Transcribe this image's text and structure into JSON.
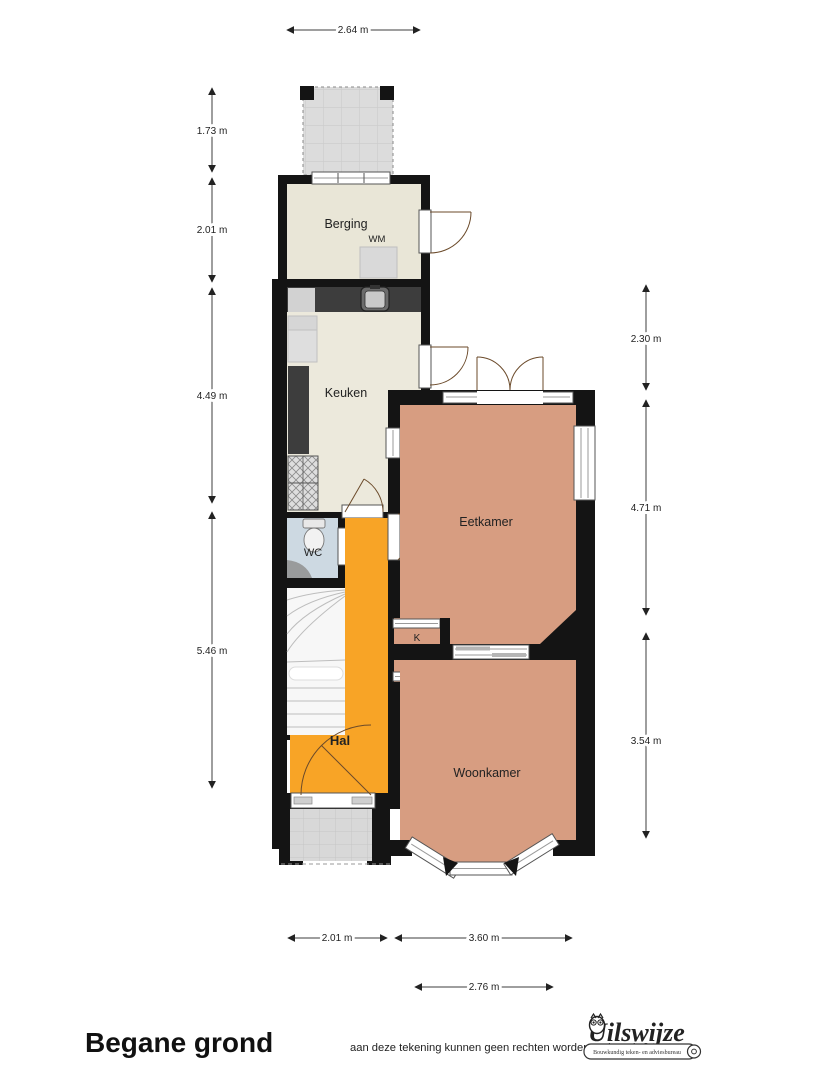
{
  "title": "Begane grond",
  "rooms": {
    "berging": "Berging",
    "wm": "WM",
    "keuken": "Keuken",
    "wc": "WC",
    "hal": "Hal",
    "eetkamer": "Eetkamer",
    "woonkamer": "Woonkamer",
    "houtkachel": "Houtkachel",
    "closet1": "K",
    "closet2": "K"
  },
  "dimensions": {
    "top": "2.64 m",
    "left": [
      "1.73 m",
      "2.01 m",
      "4.49 m",
      "5.46 m"
    ],
    "right": [
      "2.30 m",
      "4.71 m",
      "3.54 m"
    ],
    "bottom_row1": [
      "2.01 m",
      "3.60 m"
    ],
    "bottom_row2": "2.76 m"
  },
  "footer": {
    "disclaimer": "aan deze tekening kunnen geen rechten worden ontleend. ©",
    "logo": {
      "name": "Uilswijze",
      "tagline": "Bouwkundig teken- en adviesbureau"
    }
  },
  "colors": {
    "wall": "#141414",
    "living_floor": "#d79d81",
    "hall_floor": "#f8a426",
    "wc_floor": "#cdd9e2",
    "kitchen_floor": "#ece9dc",
    "berging_floor": "#e9e6d7",
    "counter": "#3d3d3d",
    "terrace": "#dcdcdc",
    "stairs": "#f7f7f7"
  }
}
